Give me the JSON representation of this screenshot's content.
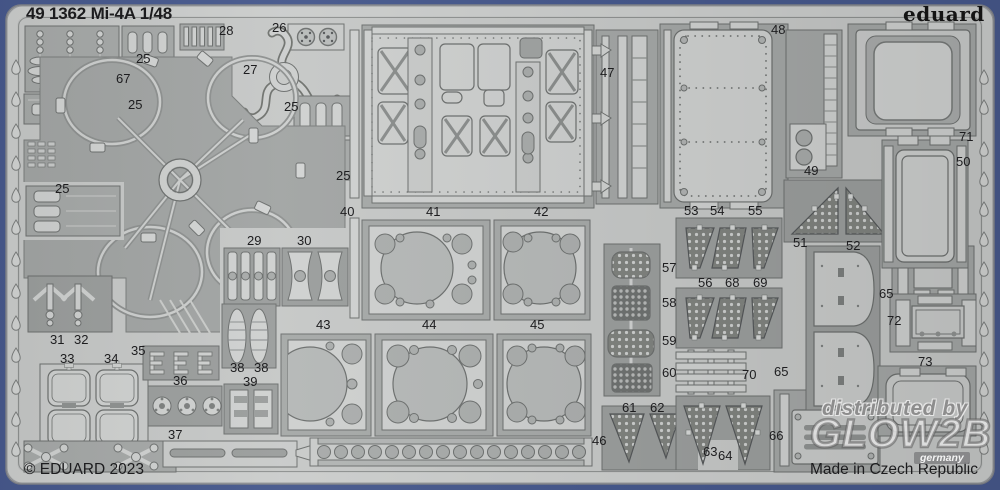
{
  "header": {
    "title": "49 1362 Mi-4A 1/48",
    "brand_logo": "eduard"
  },
  "footer": {
    "copyright": "© EDUARD 2023",
    "made_in": "Made in Czech Republic"
  },
  "watermark": {
    "line1": "distributed by",
    "line2": "GLOW2B",
    "line3": "germany"
  },
  "colors": {
    "border_blue": "#47598d",
    "sheet_base": "#bfc1c0",
    "sheet_inner": "#c6c8c7",
    "pocket": "#a6a9a8",
    "pocket_dark": "#9b9e9d",
    "part_light": "#cfd1d0",
    "outline": "#6d706f",
    "label_ink": "#1d1d1f"
  },
  "parts": [
    {
      "label": "67",
      "x": 116,
      "y": 72
    },
    {
      "label": "25",
      "x": 136,
      "y": 52
    },
    {
      "label": "28",
      "x": 219,
      "y": 24
    },
    {
      "label": "26",
      "x": 272,
      "y": 21
    },
    {
      "label": "27",
      "x": 243,
      "y": 63
    },
    {
      "label": "25",
      "x": 128,
      "y": 98
    },
    {
      "label": "25",
      "x": 284,
      "y": 100
    },
    {
      "label": "25",
      "x": 336,
      "y": 169
    },
    {
      "label": "25",
      "x": 55,
      "y": 182
    },
    {
      "label": "29",
      "x": 247,
      "y": 234
    },
    {
      "label": "30",
      "x": 297,
      "y": 234
    },
    {
      "label": "31",
      "x": 50,
      "y": 333
    },
    {
      "label": "32",
      "x": 74,
      "y": 333
    },
    {
      "label": "33",
      "x": 60,
      "y": 352
    },
    {
      "label": "34",
      "x": 104,
      "y": 352
    },
    {
      "label": "35",
      "x": 131,
      "y": 344
    },
    {
      "label": "36",
      "x": 173,
      "y": 374
    },
    {
      "label": "38",
      "x": 230,
      "y": 361
    },
    {
      "label": "38",
      "x": 254,
      "y": 361
    },
    {
      "label": "39",
      "x": 243,
      "y": 375
    },
    {
      "label": "37",
      "x": 168,
      "y": 428
    },
    {
      "label": "40",
      "x": 340,
      "y": 205
    },
    {
      "label": "41",
      "x": 426,
      "y": 205
    },
    {
      "label": "42",
      "x": 534,
      "y": 205
    },
    {
      "label": "43",
      "x": 316,
      "y": 318
    },
    {
      "label": "44",
      "x": 422,
      "y": 318
    },
    {
      "label": "45",
      "x": 530,
      "y": 318
    },
    {
      "label": "46",
      "x": 592,
      "y": 434
    },
    {
      "label": "47",
      "x": 600,
      "y": 66
    },
    {
      "label": "48",
      "x": 771,
      "y": 23
    },
    {
      "label": "49",
      "x": 804,
      "y": 164
    },
    {
      "label": "71",
      "x": 959,
      "y": 130
    },
    {
      "label": "50",
      "x": 956,
      "y": 155
    },
    {
      "label": "51",
      "x": 793,
      "y": 236
    },
    {
      "label": "52",
      "x": 846,
      "y": 239
    },
    {
      "label": "53",
      "x": 684,
      "y": 204
    },
    {
      "label": "54",
      "x": 710,
      "y": 204
    },
    {
      "label": "55",
      "x": 748,
      "y": 204
    },
    {
      "label": "56",
      "x": 698,
      "y": 276
    },
    {
      "label": "68",
      "x": 725,
      "y": 276
    },
    {
      "label": "69",
      "x": 753,
      "y": 276
    },
    {
      "label": "57",
      "x": 662,
      "y": 261
    },
    {
      "label": "58",
      "x": 662,
      "y": 296
    },
    {
      "label": "59",
      "x": 662,
      "y": 334
    },
    {
      "label": "60",
      "x": 662,
      "y": 366
    },
    {
      "label": "70",
      "x": 742,
      "y": 368
    },
    {
      "label": "65",
      "x": 774,
      "y": 365
    },
    {
      "label": "61",
      "x": 622,
      "y": 401
    },
    {
      "label": "62",
      "x": 650,
      "y": 401
    },
    {
      "label": "63",
      "x": 703,
      "y": 445
    },
    {
      "label": "64",
      "x": 718,
      "y": 449
    },
    {
      "label": "66",
      "x": 769,
      "y": 429
    },
    {
      "label": "65",
      "x": 879,
      "y": 287
    },
    {
      "label": "72",
      "x": 887,
      "y": 314
    },
    {
      "label": "73",
      "x": 918,
      "y": 355
    }
  ]
}
